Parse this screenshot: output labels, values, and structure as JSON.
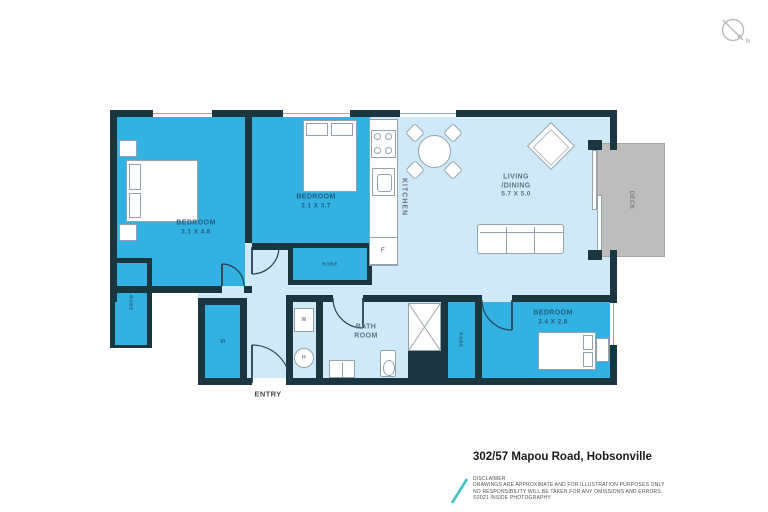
{
  "compass": {
    "north_label": "N"
  },
  "plan": {
    "bedroom1": {
      "name": "BEDROOM",
      "dims": "3.1 X 4.8"
    },
    "bedroom2": {
      "name": "BEDROOM",
      "dims": "3.1 X 3.7"
    },
    "bedroom3": {
      "name": "BEDROOM",
      "dims": "3.4 X 2.8"
    },
    "living": {
      "line1": "LIVING",
      "line2": "/DINING",
      "dims": "5.7 X 5.0"
    },
    "kitchen": {
      "name": "KITCHEN"
    },
    "bathroom": {
      "line1": "BATH",
      "line2": "ROOM"
    },
    "deck": {
      "name": "DECK"
    },
    "entry": {
      "name": "ENTRY"
    },
    "storage": {
      "name": "S"
    },
    "robe_bed1": {
      "name": "ROBE"
    },
    "robe_bed2": {
      "name": "ROBE"
    },
    "robe_bed3": {
      "name": "ROBE"
    },
    "fridge": {
      "name": "F"
    },
    "washer": {
      "name": "W"
    },
    "dryer": {
      "name": "H"
    }
  },
  "footer": {
    "address": "302/57 Mapou Road, Hobsonville",
    "disclaimer_heading": "DISCLAIMER",
    "disclaimer_lines": [
      "DRAWINGS ARE APPROXIMATE AND FOR ILLUSTRATION PURPOSES ONLY",
      "NO RESPONSIBILITY WILL BE TAKEN FOR ANY OMISSIONS AND ERRORS.",
      "©2021 INSIDE PHOTOGRAPHY"
    ]
  },
  "colors": {
    "wall": "#1c3640",
    "room_blue": "#33b1e3",
    "room_light": "#cfe9f8",
    "deck_gray": "#bdbdbd",
    "accent_teal": "#3ec2c6"
  }
}
